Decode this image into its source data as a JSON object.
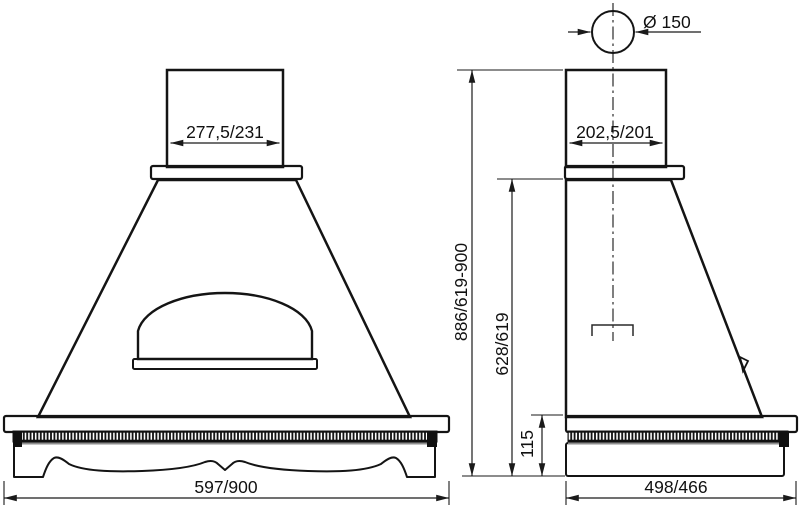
{
  "front_view": {
    "duct_width": "277,5/231",
    "base_width": "597/900"
  },
  "side_view": {
    "duct_diameter": "Ø 150",
    "duct_width": "202,5/201",
    "total_height": "886/619-900",
    "body_height": "628/619",
    "base_height": "115",
    "depth": "498/466"
  },
  "colors": {
    "wood_beige": "#ebd9ba",
    "outline": "#1a1a1a",
    "duct_gray_dark": "#bcbcbc",
    "duct_gray_light": "#f3f3f3",
    "background": "#ffffff"
  }
}
